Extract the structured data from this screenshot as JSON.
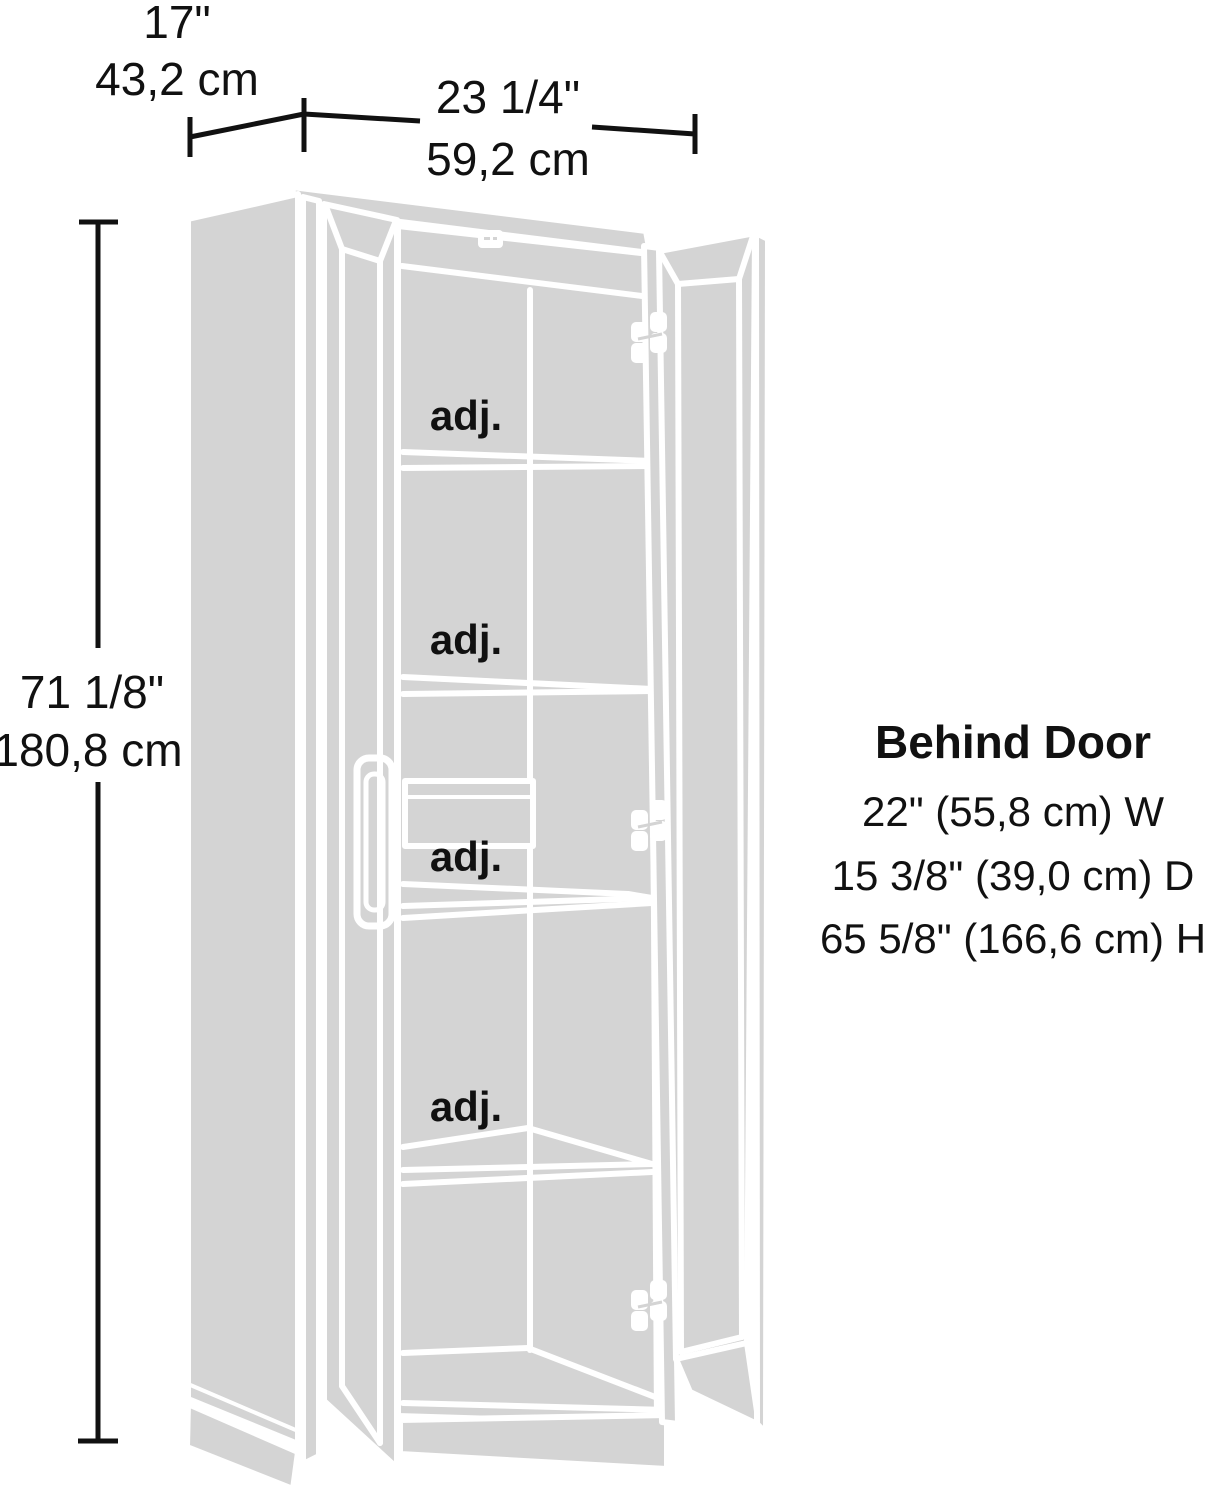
{
  "colors": {
    "fill": "#d4d4d4",
    "line": "#ffffff",
    "ink": "#111111",
    "bg": "#ffffff"
  },
  "dimensions": {
    "depth": {
      "inches": "17\"",
      "metric": "43,2 cm"
    },
    "width": {
      "inches": "23 1/4\"",
      "metric": "59,2 cm"
    },
    "height": {
      "inches": "71 1/8\"",
      "metric": "180,8 cm"
    }
  },
  "behind_door": {
    "title": "Behind Door",
    "lines": [
      "22\" (55,8 cm) W",
      "15 3/8\" (39,0 cm) D",
      "65 5/8\" (166,6 cm) H"
    ]
  },
  "shelf_labels": [
    "adj.",
    "adj.",
    "adj.",
    "adj."
  ]
}
